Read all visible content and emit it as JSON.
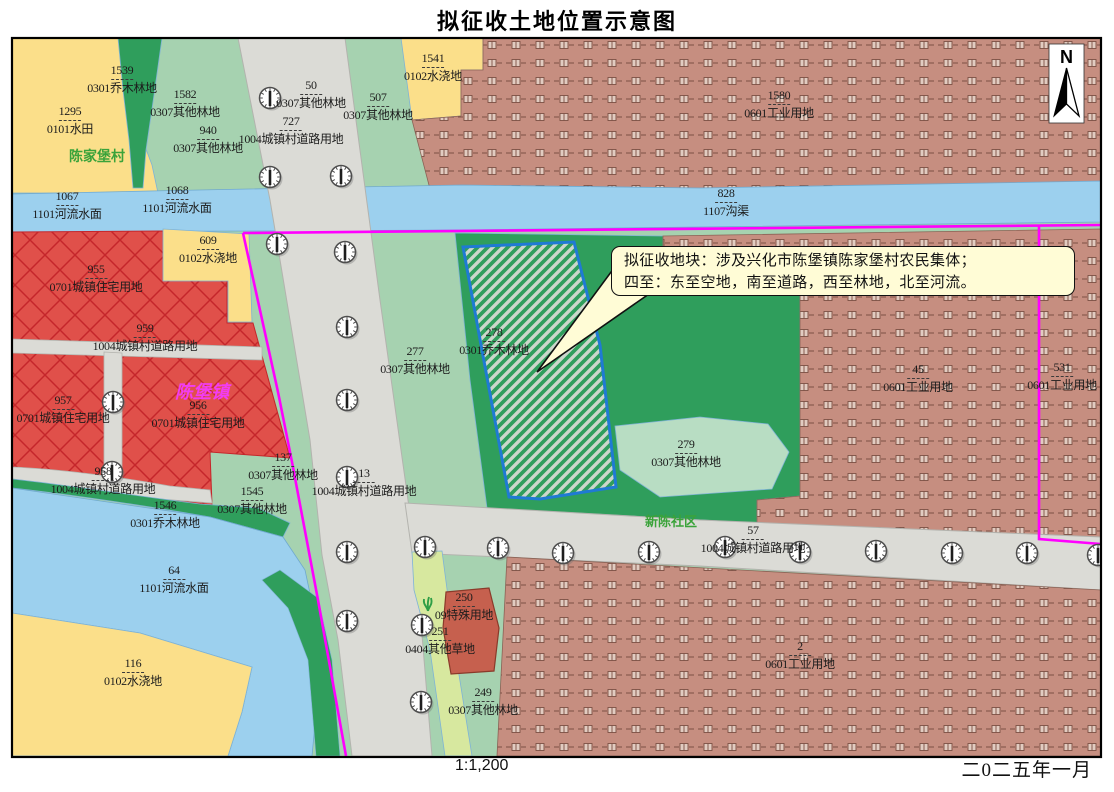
{
  "title": "拟征收土地位置示意图",
  "footer": {
    "scale": "1:1,200",
    "date": "二0二五年一月"
  },
  "north_label": "N",
  "callout": {
    "line1": "拟征收地块：涉及兴化市陈堡镇陈家堡村农民集体；",
    "line2": "四至：东至空地，南至道路，西至林地，北至河流。"
  },
  "colors": {
    "boundary_magenta": "#ff00ff",
    "target_parcel_outline": "#1f7ad4",
    "paddy_yellow": "#fbdf8a",
    "forest_light_green": "#a6d2b0",
    "forest_dark_green": "#2f9e5c",
    "grass_strip": "#d7e89f",
    "industrial_brown": "#c68e80",
    "residential_red": "#e0504a",
    "road_gray": "#dbdbd6",
    "river_blue": "#9cd0ee",
    "special_parcel": "#c6604e",
    "callout_bg": "#fffcd6"
  },
  "legend": {
    "0101": "水田",
    "0102": "水浇地",
    "0301": "乔木林地",
    "0307": "其他林地",
    "0404": "其他草地",
    "0601": "工业用地",
    "0701": "城镇住宅用地",
    "09": "特殊用地",
    "1004": "城镇村道路用地",
    "1101": "河流水面",
    "1107": "沟渠"
  },
  "place_labels": [
    {
      "text": "陈家堡村",
      "x": 97,
      "y": 146,
      "size": 14,
      "color": "#3aa33a",
      "italic": false
    },
    {
      "text": "陈堡镇",
      "x": 202,
      "y": 378,
      "size": 18,
      "color": "#f23cf2",
      "italic": true
    },
    {
      "text": "新陈社区",
      "x": 671,
      "y": 511,
      "size": 13,
      "color": "#3aa33a",
      "italic": false
    }
  ],
  "parcel_labels": [
    {
      "num": "1539",
      "type": "0301乔木林地",
      "x": 122,
      "y": 64
    },
    {
      "num": "1295",
      "type": "0101水田",
      "x": 70,
      "y": 105
    },
    {
      "num": "1582",
      "type": "0307其他林地",
      "x": 185,
      "y": 88
    },
    {
      "num": "940",
      "type": "0307其他林地",
      "x": 208,
      "y": 124
    },
    {
      "num": "50",
      "type": "0307其他林地",
      "x": 311,
      "y": 79
    },
    {
      "num": "727",
      "type": "1004城镇村道路用地",
      "x": 291,
      "y": 115
    },
    {
      "num": "507",
      "type": "0307其他林地",
      "x": 378,
      "y": 91
    },
    {
      "num": "1541",
      "type": "0102水浇地",
      "x": 433,
      "y": 52
    },
    {
      "num": "1580",
      "type": "0601工业用地",
      "x": 779,
      "y": 89
    },
    {
      "num": "828",
      "type": "1107沟渠",
      "x": 726,
      "y": 187
    },
    {
      "num": "1067",
      "type": "1101河流水面",
      "x": 67,
      "y": 190
    },
    {
      "num": "1068",
      "type": "1101河流水面",
      "x": 177,
      "y": 184
    },
    {
      "num": "609",
      "type": "0102水浇地",
      "x": 208,
      "y": 234
    },
    {
      "num": "955",
      "type": "0701城镇住宅用地",
      "x": 96,
      "y": 263
    },
    {
      "num": "959",
      "type": "1004城镇村道路用地",
      "x": 145,
      "y": 322
    },
    {
      "num": "957",
      "type": "0701城镇住宅用地",
      "x": 63,
      "y": 394
    },
    {
      "num": "956",
      "type": "0701城镇住宅用地",
      "x": 198,
      "y": 399
    },
    {
      "num": "958",
      "type": "1004城镇村道路用地",
      "x": 103,
      "y": 465
    },
    {
      "num": "1546",
      "type": "0301乔木林地",
      "x": 165,
      "y": 499
    },
    {
      "num": "137",
      "type": "0307其他林地",
      "x": 283,
      "y": 451
    },
    {
      "num": "1545",
      "type": "0307其他林地",
      "x": 252,
      "y": 485
    },
    {
      "num": "64",
      "type": "1101河流水面",
      "x": 174,
      "y": 564
    },
    {
      "num": "116",
      "type": "0102水浇地",
      "x": 133,
      "y": 657
    },
    {
      "num": "277",
      "type": "0307其他林地",
      "x": 415,
      "y": 345
    },
    {
      "num": "278",
      "type": "0301乔木林地",
      "x": 494,
      "y": 326
    },
    {
      "num": "13",
      "type": "1004城镇村道路用地",
      "x": 364,
      "y": 467
    },
    {
      "num": "279",
      "type": "0307其他林地",
      "x": 686,
      "y": 438
    },
    {
      "num": "57",
      "type": "1004城镇村道路用地",
      "x": 753,
      "y": 524
    },
    {
      "num": "45",
      "type": "0601工业用地",
      "x": 918,
      "y": 363
    },
    {
      "num": "531",
      "type": "0601工业用地",
      "x": 1062,
      "y": 361
    },
    {
      "num": "2",
      "type": "0601工业用地",
      "x": 800,
      "y": 640
    },
    {
      "num": "250",
      "type": "09特殊用地",
      "x": 464,
      "y": 591
    },
    {
      "num": "251",
      "type": "0404其他草地",
      "x": 440,
      "y": 625
    },
    {
      "num": "249",
      "type": "0307其他林地",
      "x": 483,
      "y": 686
    }
  ],
  "trees": [
    [
      270,
      98
    ],
    [
      270,
      177
    ],
    [
      341,
      176
    ],
    [
      345,
      252
    ],
    [
      347,
      327
    ],
    [
      347,
      400
    ],
    [
      347,
      477
    ],
    [
      347,
      552
    ],
    [
      347,
      621
    ],
    [
      422,
      625
    ],
    [
      421,
      702
    ],
    [
      425,
      547
    ],
    [
      498,
      548
    ],
    [
      563,
      553
    ],
    [
      649,
      552
    ],
    [
      725,
      547
    ],
    [
      800,
      552
    ],
    [
      876,
      551
    ],
    [
      952,
      553
    ],
    [
      1027,
      553
    ],
    [
      1098,
      555
    ],
    [
      113,
      402
    ],
    [
      112,
      472
    ],
    [
      277,
      244
    ]
  ],
  "grass_symbol": {
    "x": 428,
    "y": 604
  }
}
